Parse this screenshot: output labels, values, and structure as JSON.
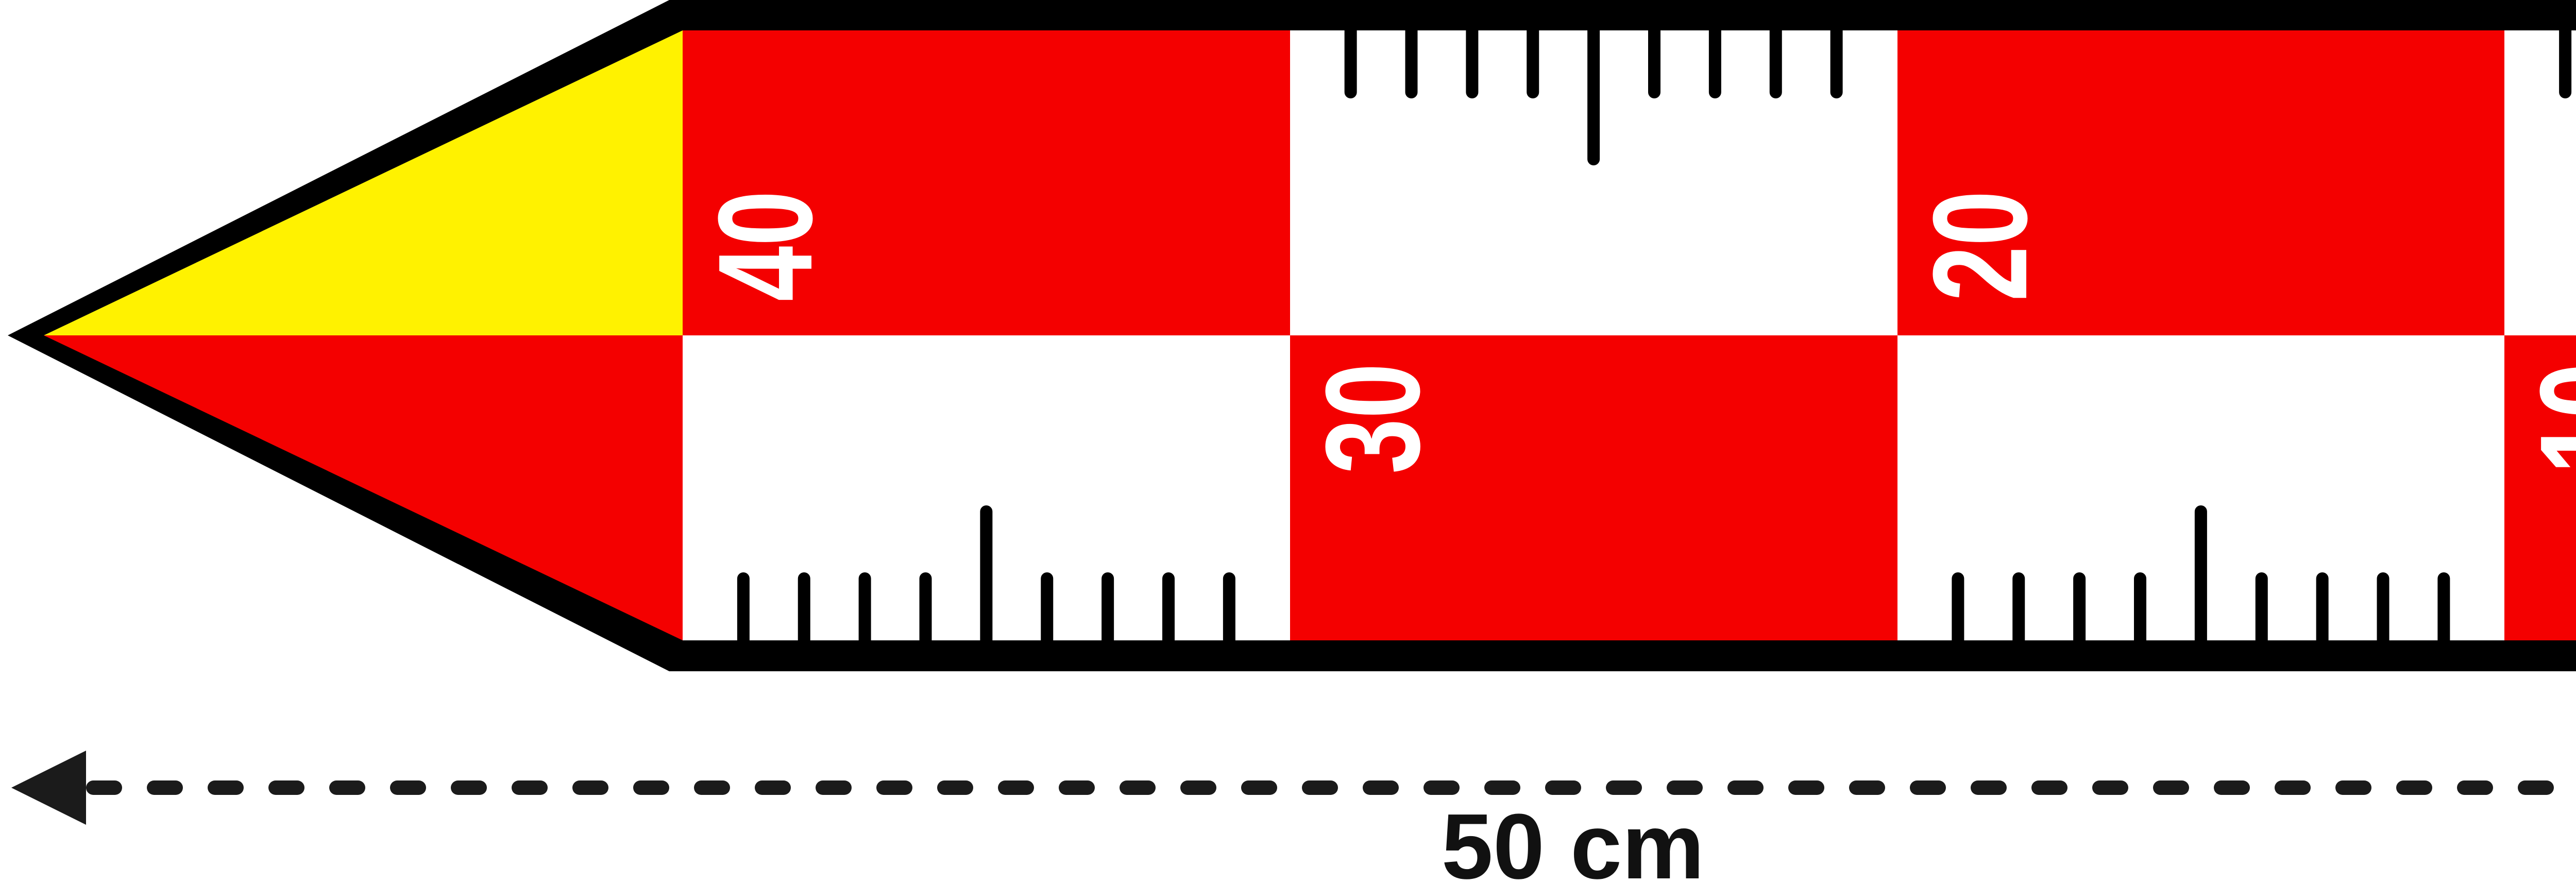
{
  "title": "Archaeological photographic scale bar 50 cm",
  "scale_bar": {
    "unit_label": "cm",
    "total_cm": 50,
    "square_cm": 10,
    "labels": [
      "40",
      "30",
      "20",
      "10"
    ],
    "tick_marks": {
      "top_cm": [
        1,
        2,
        3,
        4,
        5,
        6,
        7,
        8,
        9,
        21,
        22,
        23,
        24,
        25,
        26,
        27,
        28,
        29
      ],
      "bottom_cm": [
        11,
        12,
        13,
        14,
        15,
        16,
        17,
        18,
        19,
        31,
        32,
        33,
        34,
        35,
        36,
        37,
        38,
        39
      ],
      "long_interval_cm": 5
    },
    "colors": {
      "red": "#f40000",
      "yellow": "#fff200",
      "black": "#000000",
      "white": "#ffffff"
    }
  },
  "dimension_annotations": {
    "width_label": "50 cm",
    "height_label": "10 cm"
  },
  "logo": {
    "brand": "Archeoshop",
    "tagline": "nářadí a potřeby pro archeology",
    "website": "WWW.ARCHEOSHOP.CZ"
  }
}
